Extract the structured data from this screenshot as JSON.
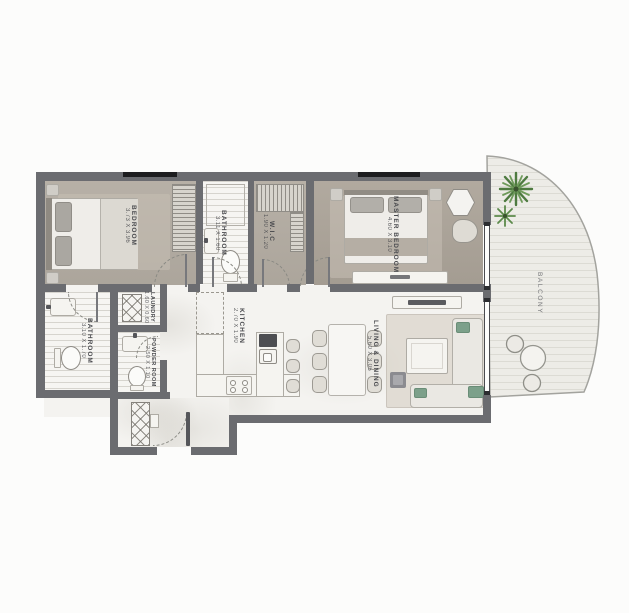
{
  "plan": {
    "type": "apartment-floor-plan",
    "rooms": {
      "bedroom": {
        "name": "BEDROOM",
        "dims": "3.73 X 3.96"
      },
      "bathroom_top": {
        "name": "BATHROOM",
        "dims": "3.11 X 1.60"
      },
      "wic": {
        "name": "W.I.C",
        "dims": "1.90 X 1.20"
      },
      "master_bedroom": {
        "name": "MASTER BEDROOM",
        "dims": "4.60 X 3.10"
      },
      "balcony": {
        "name": "BALCONY"
      },
      "bathroom_main": {
        "name": "BATHROOM",
        "dims": "3.10 X 1.70"
      },
      "laundry": {
        "name": "LAUNDRY",
        "dims": "1.60 X 0.60"
      },
      "powder_room": {
        "name": "POWDER ROOM",
        "dims": "2.50 X 1.10"
      },
      "kitchen": {
        "name": "KITCHEN",
        "dims": "2.70 X 1.90"
      },
      "living_dining": {
        "name": "LIVING & DINING",
        "dims": "5.60 X 3.05"
      }
    },
    "colors": {
      "wall": "#6b6c70",
      "wood": "#b3aca2",
      "marble": "#f4f3f0",
      "tile": "#f6f5f2",
      "balcony": "#edece7",
      "green": "#7ca08a",
      "plant": "#55813f",
      "win": "#1d1d1f"
    }
  }
}
